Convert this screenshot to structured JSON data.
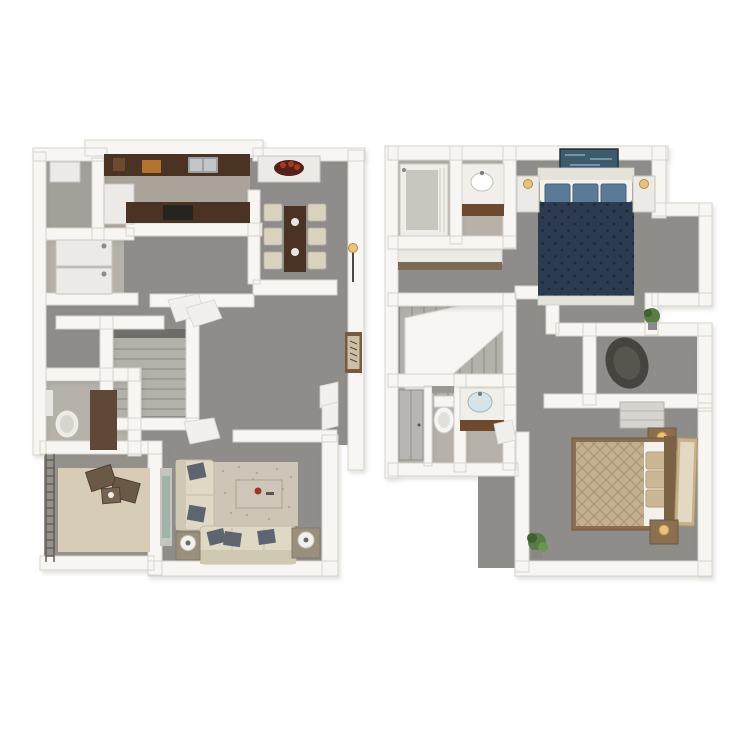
{
  "image": {
    "type": "3d-floor-plan-rendering",
    "description": "Two-story apartment 3D top-down floor plans side by side on white background",
    "panels": [
      {
        "name": "first-floor-plan",
        "position": "left",
        "rooms": [
          "kitchen",
          "dining-area",
          "pantry",
          "laundry-closet",
          "staircase",
          "bathroom",
          "hallway",
          "living-room",
          "patio"
        ],
        "furnishings": [
          "kitchen-counter",
          "kitchen-sink",
          "kitchen-peninsula",
          "cooktop",
          "cabinet",
          "stacked-washer-dryer",
          "dining-console",
          "fruit-bowl",
          "dining-table",
          "dining-chairs",
          "floor-lamp",
          "framed-poster",
          "bathroom-vanity-mirror",
          "bathroom-door",
          "loveseat",
          "sofa",
          "throw-pillows",
          "area-rug",
          "coffee-table",
          "side-tables",
          "table-lamps",
          "media-console",
          "patio-railing",
          "patio-rug",
          "patio-chairs",
          "patio-table",
          "open-closet-doors"
        ]
      },
      {
        "name": "second-floor-plan",
        "position": "right",
        "rooms": [
          "master-bedroom",
          "master-bathroom",
          "vanity-area",
          "linen-closet",
          "staircase",
          "hallway",
          "hall-bathroom",
          "walk-in-closet",
          "bedroom-two"
        ],
        "furnishings": [
          "bathtub",
          "vanity-sink",
          "closet-shelf",
          "wall-art",
          "master-bed",
          "navy-tufted-duvet",
          "navy-pillows",
          "nightstands",
          "table-lamps",
          "laundry-hamper",
          "potted-plant",
          "shower-stall",
          "toilet",
          "second-vanity-sink",
          "dresser",
          "queen-bed",
          "tan-patterned-duvet",
          "stacked-pillows",
          "leaning-art",
          "second-potted-plant",
          "open-door"
        ]
      }
    ]
  },
  "colors": {
    "white": "#ffffff",
    "wall": "#f7f6f3",
    "wallEdge": "#d7d4cd",
    "floor": "#8f8d89",
    "floorDark": "#94908a",
    "tile": "#b6b2aa",
    "kitchenFloor": "#a9a399",
    "pantryFloor": "#a3a099",
    "counterWood": "#4a3322",
    "woodMid": "#6b4a2e",
    "doorBrown": "#5f4936",
    "appliance": "#eceae6",
    "applianceEdge": "#c9c6c0",
    "steel": "#9aa0a4",
    "steelLight": "#c2c6c9",
    "cream": "#d8d2bf",
    "chairEdge": "#b9b4a2",
    "sofa": "#ded8c5",
    "sofaBack": "#cfc9b4",
    "sofaEdge": "#c2bca8",
    "pillowSlate": "#5d6570",
    "rug": "#cdc6b6",
    "rugDot": "#b3ab99",
    "rugPatio": "#d7cdb6",
    "navy": "#2d3b51",
    "navyDot": "#1f2b3c",
    "pillowBlue": "#5a7a97",
    "linen": "#e6e3da",
    "tan": "#c3b091",
    "tanLine": "#a89270",
    "headboardWood": "#8a6f50",
    "headboardDark": "#7c6245",
    "furnGray": "#c6c4bf",
    "sideTable": "#9a8e7c",
    "hamper": "#45443e",
    "plant": "#5a7c46",
    "plantDark": "#3f6130",
    "stair": "#b4b1ab",
    "stairLine": "#93908a",
    "stairVoid": "#6e6c67",
    "artBlue": "#3e5a6d",
    "artStreak": "#7fa3b8",
    "frameBrown": "#7a5a3a",
    "artPaper": "#cbbfa8",
    "lampWarm": "#e9c37c",
    "lampEdge": "#b98c3e",
    "glassTeal": "#9fb3a8",
    "fruitBowl": "#54201a",
    "fruit": "#a33b25",
    "orangeBoard": "#b5722e",
    "sinkBlue": "#d9e4e9"
  }
}
